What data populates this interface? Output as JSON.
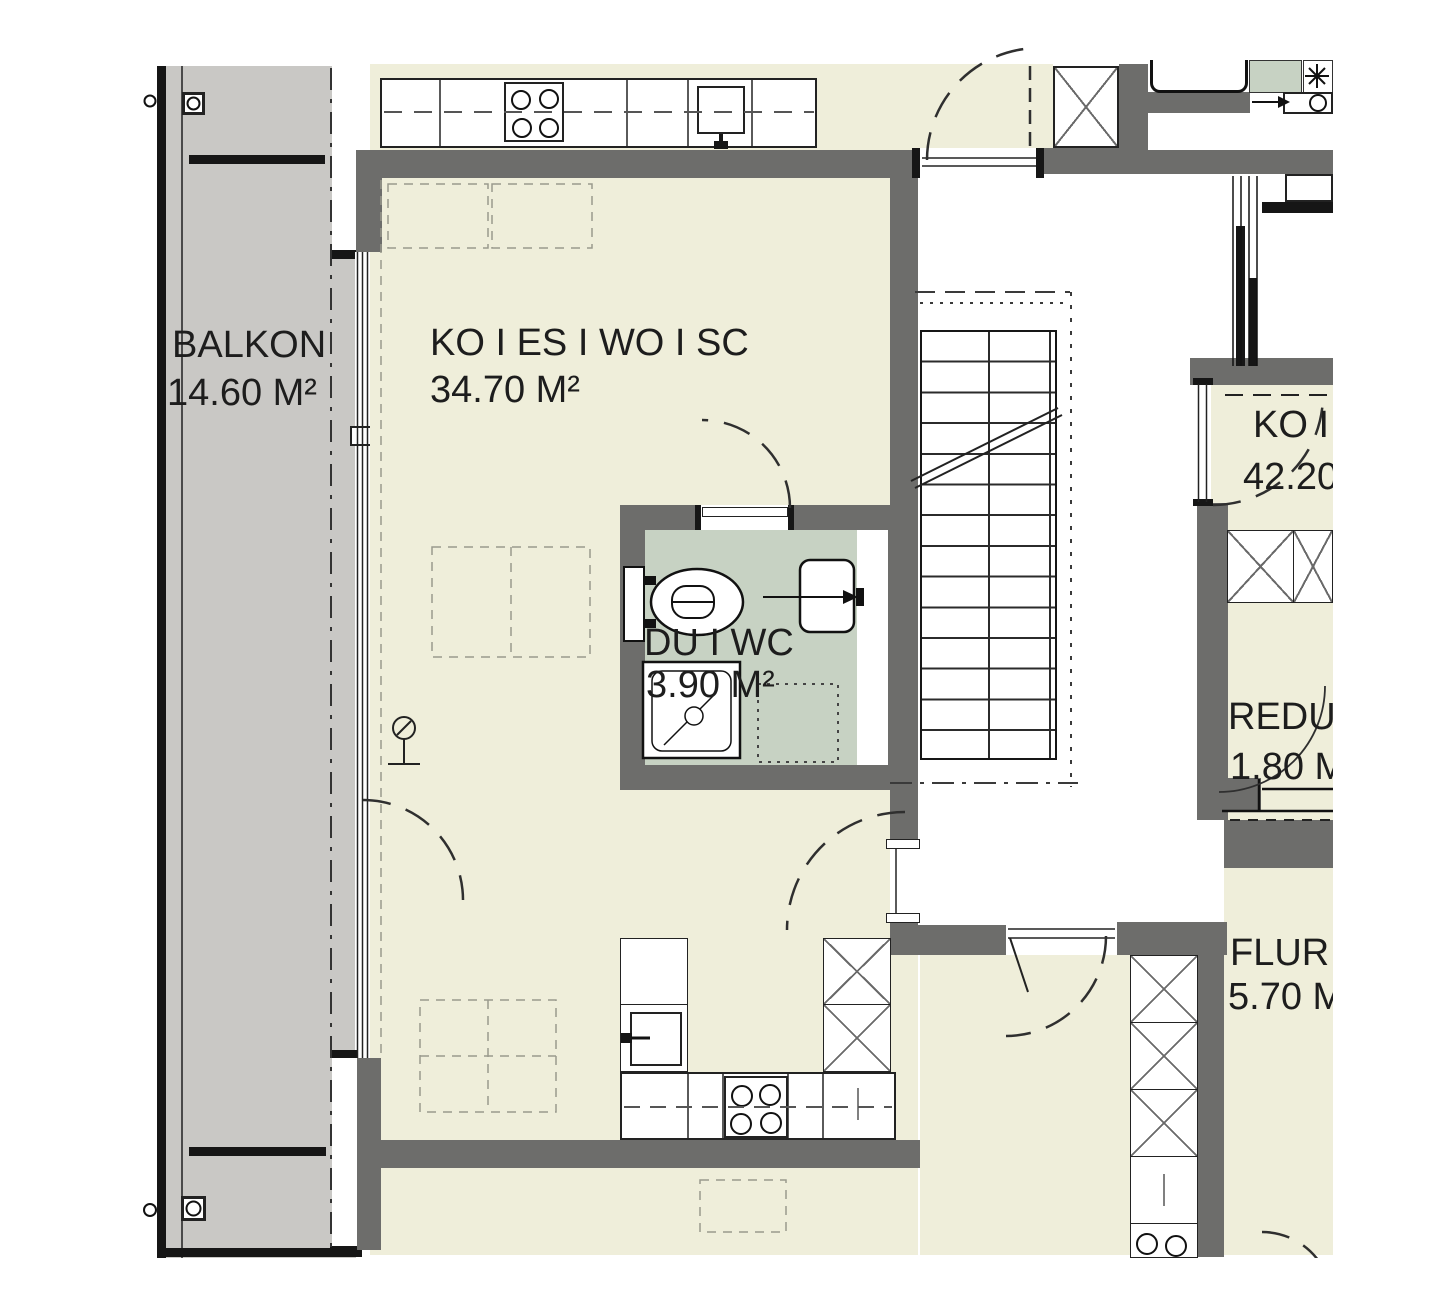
{
  "document": {
    "type": "architectural-floor-plan"
  },
  "rooms": {
    "balkon": {
      "name": "BALKON",
      "area": "14.60 M²"
    },
    "living": {
      "name": "KO I ES I WO I SC",
      "area": "34.70 M²"
    },
    "bath": {
      "name": "DU I WC",
      "area": "3.90 M²"
    },
    "right": {
      "name": "KO I",
      "area": "42.20"
    },
    "reduit": {
      "name": "REDU",
      "area": "1.80 M"
    },
    "flur": {
      "name": "FLUR",
      "area": "5.70 M"
    }
  },
  "colors": {
    "floor": "#efeeda",
    "balcony": "#c9c8c5",
    "wall": "#6d6d6b",
    "bath": "#c7d2c3",
    "line": "#1c1c1c"
  },
  "icons": {
    "stove": "four-burner-cooktop",
    "sink": "kitchen-sink",
    "toilet": "wc-toilet",
    "shower": "shower-tray",
    "bathtub": "bathtub",
    "washbasin": "washbasin",
    "stairs": "staircase-run"
  }
}
